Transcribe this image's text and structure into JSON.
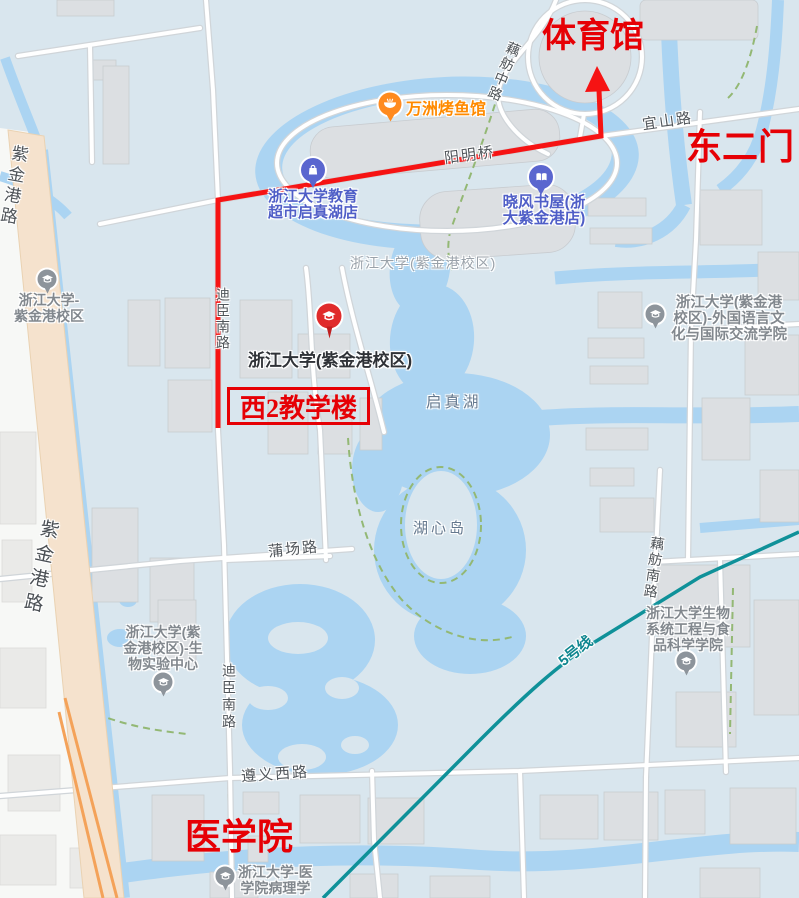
{
  "colors": {
    "campus_bg": "#d9e6ee",
    "outside_bg": "#f7f8f6",
    "water": "#abd4f2",
    "building": "#dcdfe2",
    "building_outside": "#eaeae8",
    "road_fill": "#ffffff",
    "road_casing": "#d0d5d9",
    "main_road": "#f5e2cd",
    "bridge_edge": "#f4a259",
    "metro_teal": "#0f9199",
    "route_red": "#f61313",
    "annotation_red": "#e60005",
    "poi_text_blue": "#4f5ec7",
    "poi_orange": "#ff8a00",
    "poi_gray": "#8d949b",
    "road_label": "#50555a",
    "water_label": "#64788e",
    "campus_label": "#9aa2aa",
    "path_green": "#93b874"
  },
  "annotations": {
    "gym": "体育馆",
    "east_gate": "东二门",
    "west2_building": "西2教学楼",
    "medical_school": "医学院"
  },
  "pois": {
    "restaurant": {
      "label": "万洲烤鱼馆",
      "icon": "bowl-icon"
    },
    "supermarket": {
      "lines": [
        "浙江大学教育",
        "超市启真湖店"
      ],
      "icon": "shopping-bag-icon"
    },
    "bookstore": {
      "lines": [
        "晓风书屋(浙",
        "大紫金港店)"
      ],
      "icon": "book-icon"
    },
    "university_main": {
      "label": "浙江大学(紫金港校区)",
      "icon": "graduation-cap-icon"
    },
    "west_campus": {
      "lines": [
        "浙江大学-",
        "紫金港校区"
      ],
      "icon": "graduation-cap-icon"
    },
    "bio_lab": {
      "lines": [
        "浙江大学(紫",
        "金港校区)-生",
        "物实验中心"
      ],
      "icon": "graduation-cap-icon"
    },
    "foreign_lang": {
      "lines": [
        "浙江大学(紫金港",
        "校区)-外国语言文",
        "化与国际交流学院"
      ],
      "icon": "graduation-cap-icon"
    },
    "food_science": {
      "lines": [
        "浙江大学生物",
        "系统工程与食",
        "品科学学院"
      ],
      "icon": "graduation-cap-icon"
    },
    "pathology": {
      "lines": [
        "浙江大学-医",
        "学院病理学"
      ],
      "icon": "graduation-cap-icon"
    }
  },
  "road_labels": {
    "zijingang_top": "紫金港路",
    "zijingang_west": "紫金港路",
    "dichen_north": "迪臣南路",
    "dichen_south": "迪臣南路",
    "oufang_mid": "藕舫中路",
    "oufang_south": "藕舫南路",
    "yishan": "宜山路",
    "yangming_bridge": "阳明桥",
    "puchang": "蒲场路",
    "zunyi_west": "遵义西路",
    "metro_line5": "5号线"
  },
  "water_labels": {
    "qizhen_lake": "启真湖",
    "huxin_island": "湖心岛"
  },
  "area_labels": {
    "campus": "浙江大学(紫金港校区)"
  }
}
